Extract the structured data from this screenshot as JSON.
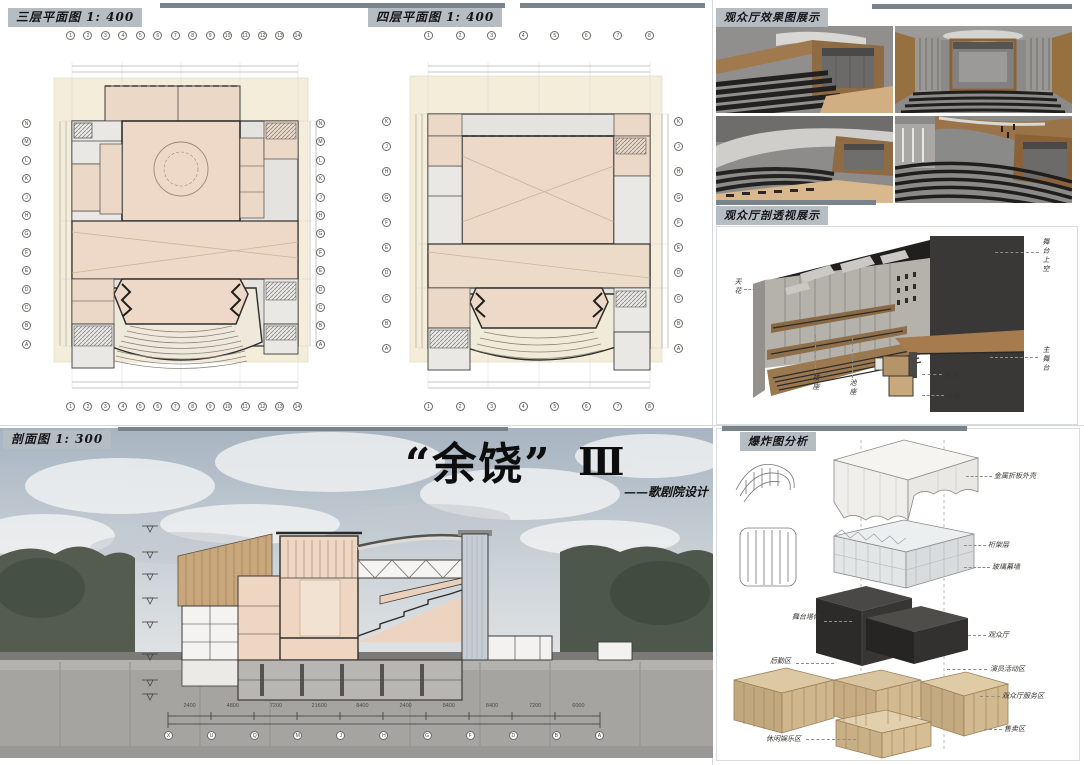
{
  "board": {
    "main_title": {
      "display": "“余饶”",
      "numeral": "Ⅲ",
      "subtitle": "——歌剧院设计"
    }
  },
  "panels": {
    "plan3": {
      "title": "三层平面图 1: 400",
      "axis_top": [
        "1",
        "2",
        "3",
        "4",
        "5",
        "6",
        "7",
        "8",
        "9",
        "10",
        "11",
        "12",
        "13",
        "14"
      ],
      "axis_bottom": [
        "1",
        "2",
        "3",
        "4",
        "5",
        "6",
        "7",
        "8",
        "9",
        "10",
        "11",
        "12",
        "13",
        "14"
      ],
      "axis_left": [
        "N",
        "M",
        "L",
        "K",
        "J",
        "H",
        "G",
        "F",
        "E",
        "D",
        "C",
        "B",
        "A"
      ],
      "axis_right": [
        "N",
        "M",
        "L",
        "K",
        "J",
        "H",
        "G",
        "F",
        "E",
        "D",
        "C",
        "B",
        "A"
      ]
    },
    "plan4": {
      "title": "四层平面图 1: 400",
      "axis_top": [
        "1",
        "2",
        "3",
        "4",
        "5",
        "6",
        "7",
        "8"
      ],
      "axis_bottom": [
        "1",
        "2",
        "3",
        "4",
        "5",
        "6",
        "7",
        "8"
      ],
      "axis_left": [
        "K",
        "J",
        "H",
        "G",
        "F",
        "E",
        "D",
        "C",
        "B",
        "A"
      ],
      "axis_right": [
        "K",
        "J",
        "H",
        "G",
        "F",
        "E",
        "D",
        "C",
        "B",
        "A"
      ]
    },
    "renders": {
      "title": "观众厅效果图展示"
    },
    "persp": {
      "title": "观众厅剖透视展示",
      "labels": {
        "ceiling": "天花",
        "fly_space": "舞台上空",
        "main_stage": "主舞台",
        "balcony": "楼座",
        "stalls": "池座",
        "orchestra_pit": "乐池",
        "stage_trap": "台仓"
      }
    },
    "section": {
      "title": "剖面图 1: 300",
      "dimensions": [
        "2400",
        "4800",
        "7200",
        "21600",
        "8400",
        "2400",
        "8400",
        "8400",
        "7200",
        "6000"
      ],
      "grid_letters": [
        "X",
        "U",
        "Q",
        "M",
        "J",
        "H",
        "G",
        "F",
        "D",
        "B",
        "A"
      ]
    },
    "exploded": {
      "title": "爆炸图分析",
      "labels_right": [
        "金属折板外壳",
        "桁架层",
        "玻璃幕墙",
        "观众厅",
        "演员活动区",
        "观众厅服务区",
        "售卖区"
      ],
      "labels_left": [
        "舞台塔体",
        "后勤区",
        "休闲娱乐区"
      ]
    }
  },
  "colors": {
    "chip_bg": "#b5bcc2",
    "header_bar": "#79838b",
    "plan_cream": "#f3edda",
    "plan_room": "#ecd8c7",
    "section_fill": "#eed6c2",
    "wood": "#a97c4f",
    "dark_mass": "#2f2d2b",
    "sky": "#a7b4c1",
    "ground": "#a5a4a1"
  }
}
